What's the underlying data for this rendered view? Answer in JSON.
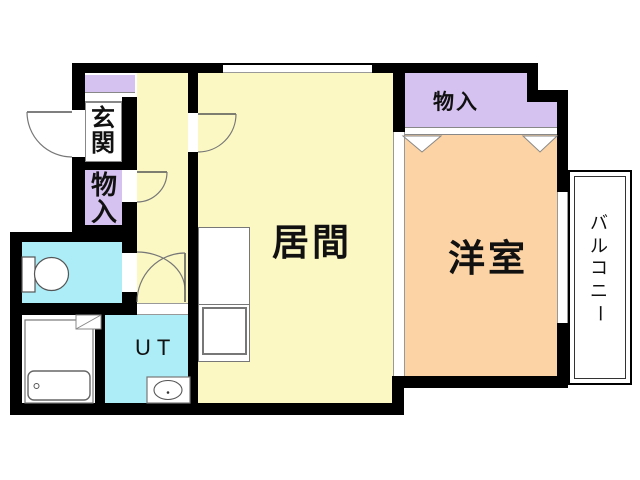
{
  "colors": {
    "wall": "#000000",
    "yellow": "#FBF8C4",
    "purple": "#D6C2F0",
    "orange": "#FCD3A4",
    "cyan": "#ACEDF7",
    "line": "#777777",
    "bg": "#FFFFFF"
  },
  "rooms": {
    "genkan": {
      "label": "玄関",
      "chars": [
        "玄",
        "関"
      ]
    },
    "monoire_left": {
      "label": "物入",
      "chars": [
        "物",
        "入"
      ]
    },
    "monoire_top": {
      "label": "物入"
    },
    "ima": {
      "label": "居間"
    },
    "yoshitsu": {
      "label": "洋室"
    },
    "ut": {
      "label": "UT"
    },
    "balcony": {
      "label": "バルコニー",
      "chars": [
        "バ",
        "ル",
        "コ",
        "ニ",
        "ー"
      ]
    }
  }
}
